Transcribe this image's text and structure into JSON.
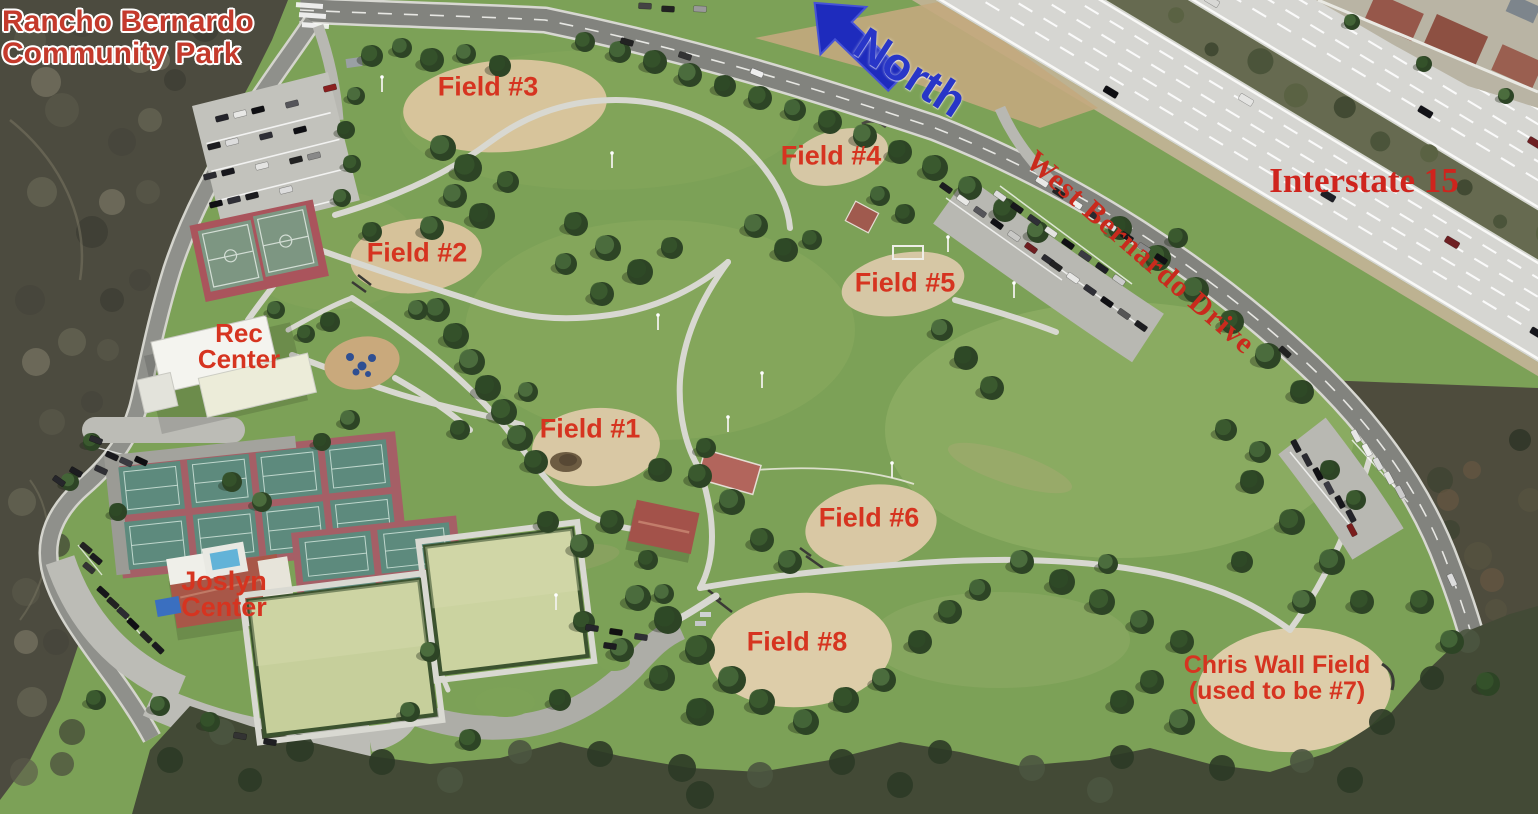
{
  "park": {
    "title_line1": "Rancho Bernardo",
    "title_line2": "Community Park"
  },
  "compass": {
    "north": "North"
  },
  "roads": {
    "west_bernardo_drive": "West Bernardo Drive",
    "interstate_15": "Interstate 15"
  },
  "facilities": {
    "rec_center_line1": "Rec",
    "rec_center_line2": "Center",
    "joslyn_center_line1": "Joslyn",
    "joslyn_center_line2": "Center"
  },
  "fields": {
    "field1": "Field #1",
    "field2": "Field #2",
    "field3": "Field #3",
    "field4": "Field #4",
    "field5": "Field #5",
    "field6": "Field #6",
    "field8": "Field #8",
    "chris_wall_line1": "Chris Wall Field",
    "chris_wall_line2": "(used to be #7)"
  },
  "colors": {
    "label_red": "#d63420",
    "title_red": "#c43a2c",
    "north_blue": "#2836c8",
    "grass_green": "#7ca157",
    "infield_tan": "#d8c59c"
  }
}
